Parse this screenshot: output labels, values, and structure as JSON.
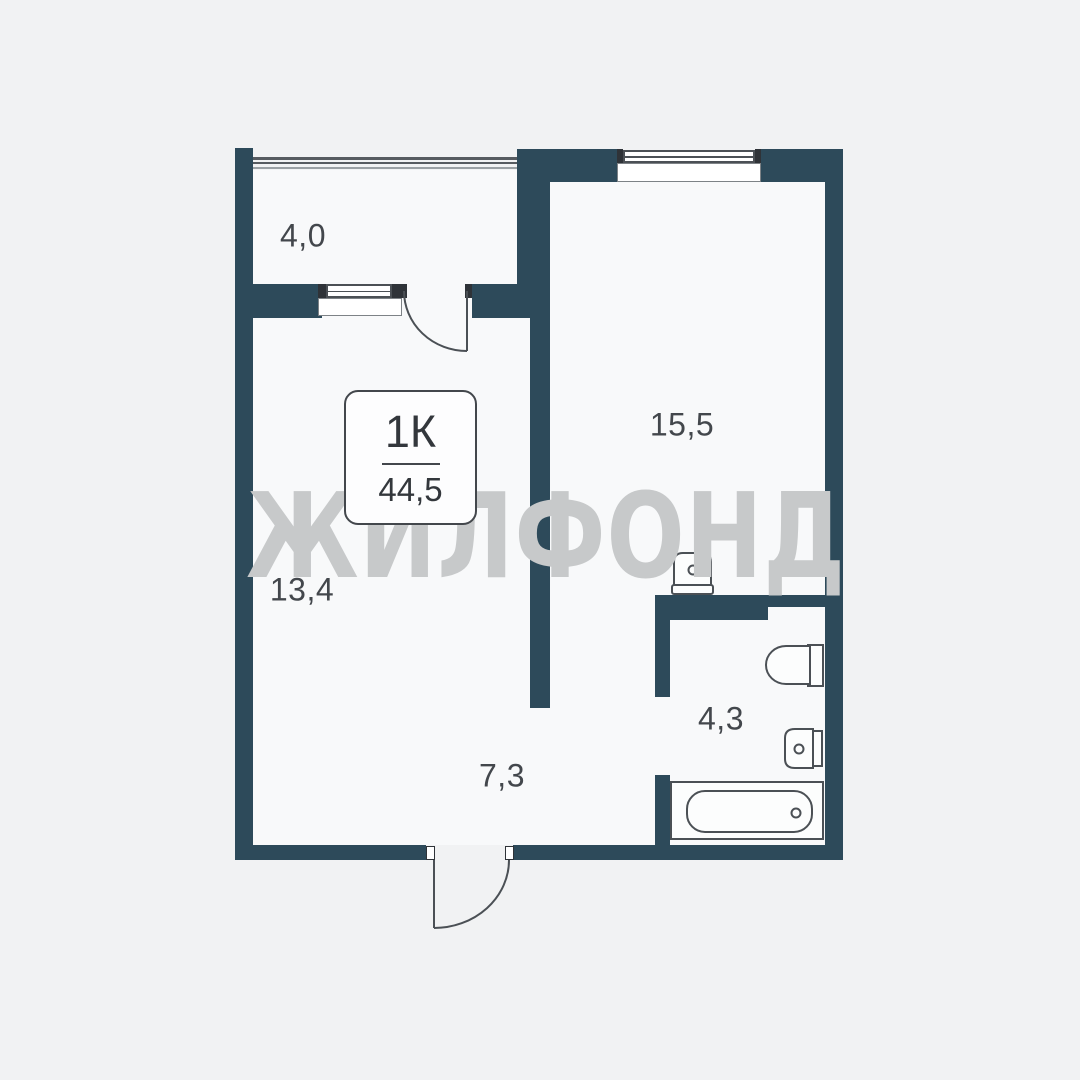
{
  "plan": {
    "watermark": "ЖИЛФОНД",
    "unit_card": {
      "type": "1К",
      "area": "44,5"
    },
    "room_labels": {
      "balcony": "4,0",
      "room": "15,5",
      "kitchen_living": "13,4",
      "hallway": "7,3",
      "bathroom": "4,3"
    }
  },
  "colors": {
    "bg": "#f1f2f3",
    "floor": "#f8f9fa",
    "wall": "#2d4a5a",
    "stroke": "#4b5055",
    "dark": "#2f3338",
    "text": "#43474c",
    "card-text": "#33373c",
    "card-border": "#43474c",
    "watermark": "#c7c9ca",
    "fixture-fill": "#fcfdfd",
    "sill-border": "#7d8286"
  }
}
